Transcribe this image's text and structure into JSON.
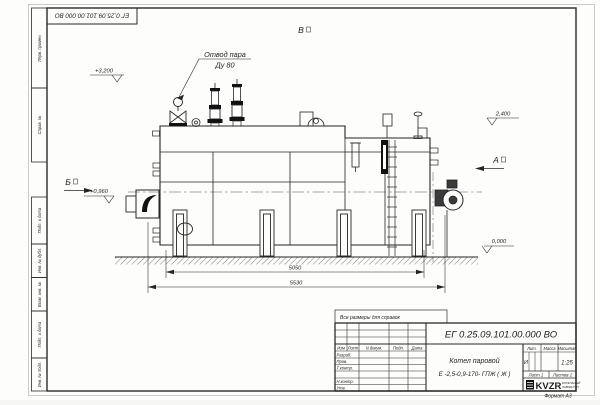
{
  "top_stamp": "ЕГ 0.25.09.101.00.000  ВО",
  "margins": {
    "labels": [
      "Перв. примен.",
      "Справ. №",
      "Подп. и дата",
      "Инв. № дубл.",
      "Взам. инв. №",
      "Подп. и дата",
      "Инв. № подл."
    ]
  },
  "annotations": {
    "steam_callout": {
      "line1": "Отвод пара",
      "line2": "Ду 80"
    },
    "elev_top": "+3,200",
    "elev_drum": "2,400",
    "elev_burner": "+0,960",
    "elev_ground": "0,000",
    "view_top": "В",
    "view_left": "Б",
    "view_right": "А",
    "dim_inner": "5050",
    "dim_outer": "5530"
  },
  "note": "Все размеры для справок",
  "title_block": {
    "doc_number": "ЕГ 0.25.09.101.00.000  ВО",
    "product_line1": "Котел паровой",
    "product_line2": "Е -2,5-0,9-170- ГПЖ ( Ж )",
    "col_izm": "Изм",
    "col_list": "Лист",
    "col_doc": "N докум.",
    "col_sign": "Подп.",
    "col_date": "Дата",
    "row_developed": "Разраб.",
    "row_checked": "Пров.",
    "row_tcontrol": "Т.контр.",
    "row_ncontrol": "Н.контр.",
    "row_approved": "Утв.",
    "lit_header": "Лит.",
    "mass_header": "Масса",
    "scale_header": "Масштаб",
    "lit_value": "И",
    "scale_value": "1:25",
    "sheet_cell": "Лист  1",
    "sheets_cell": "Листов   2",
    "logo_text": "KVZR",
    "logo_sub1": "КОТЕЛЬНЫЙ",
    "logo_sub2": "ЗАВОД РЭП",
    "format_note": "Формат А3"
  }
}
